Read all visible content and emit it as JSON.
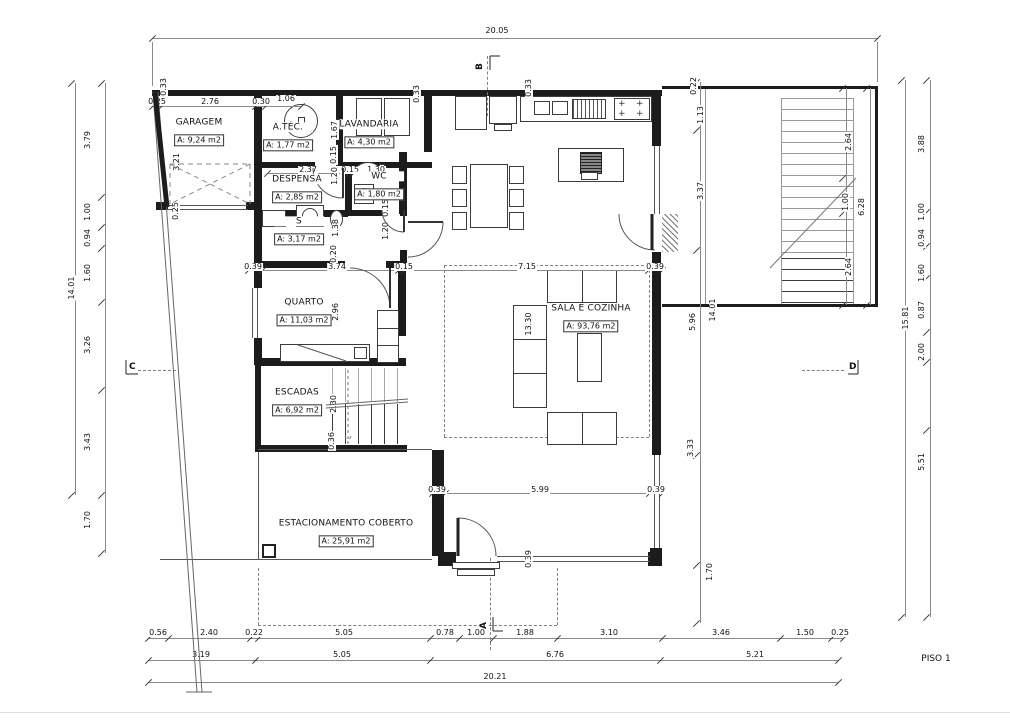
{
  "title": "PISO 1",
  "rooms": [
    {
      "name": "GARAGEM",
      "area": "A: 9,24 m2"
    },
    {
      "name": "A.TÉC.",
      "area": "A: 1,77 m2"
    },
    {
      "name": "LAVANDARIA",
      "area": "A: 4,30 m2"
    },
    {
      "name": "DESPENSA",
      "area": "A: 2,85 m2"
    },
    {
      "name": "WC",
      "area": "A: 1,80 m2"
    },
    {
      "name": "S",
      "area": "A: 3,17 m2"
    },
    {
      "name": "QUARTO",
      "area": "A: 11,03 m2"
    },
    {
      "name": "ESCADAS",
      "area": "A: 6,92 m2"
    },
    {
      "name": "SALA E COZINHA",
      "area": "A: 93,76 m2"
    },
    {
      "name": "ESTACIONAMENTO COBERTO",
      "area": "A: 25,91 m2"
    }
  ],
  "sections": {
    "a": "A",
    "b": "B",
    "c": "C",
    "d": "D"
  },
  "dims": {
    "top_overall": "20.05",
    "top_wall": [
      "0.25",
      "2.76",
      "0.30",
      "1.06"
    ],
    "garage_v": [
      "0.33",
      "3.21",
      "0.25"
    ],
    "lav_v": [
      "1.67",
      "0.15",
      "1.20",
      "1.38",
      "0.20"
    ],
    "wc_v": [
      "0.15",
      "1.20"
    ],
    "wc_row": [
      "2.37",
      "0.15",
      "1.30"
    ],
    "top_v2": [
      "0.33",
      "0.33"
    ],
    "mid_row": [
      "0.39",
      "3.74",
      "0.15",
      "7.15",
      "0.39"
    ],
    "quarto_v": "2.96",
    "sala_v": "13.30",
    "stairs_v": [
      "2.30",
      "0.36"
    ],
    "parking_row": [
      "0.39",
      "5.99",
      "0.39"
    ],
    "win_v": "0.39",
    "left_chain": [
      "3.79",
      "1.00",
      "0.94",
      "1.60",
      "3.26",
      "3.43",
      "1.70"
    ],
    "left_overall": "14.01",
    "inright_chain": [
      "0.22",
      "1.13",
      "3.37",
      "5.96",
      "3.33",
      "1.70"
    ],
    "inright_overall": "14.01",
    "stair_chain": [
      "2.64",
      "1.00",
      "2.64"
    ],
    "stair_overall": "6.28",
    "right_chain": [
      "3.88",
      "1.00",
      "0.94",
      "1.60",
      "0.87",
      "2.00",
      "5.51"
    ],
    "right_overall": "15.81",
    "bottom_row1": [
      "0.56",
      "2.40",
      "0.22",
      "5.05",
      "0.78",
      "1.00",
      "1.88",
      "3.10",
      "3.46",
      "1.50",
      "0.25"
    ],
    "bottom_row2": [
      "3.19",
      "5.05",
      "6.76",
      "5.21"
    ],
    "bottom_overall": "20.21"
  }
}
